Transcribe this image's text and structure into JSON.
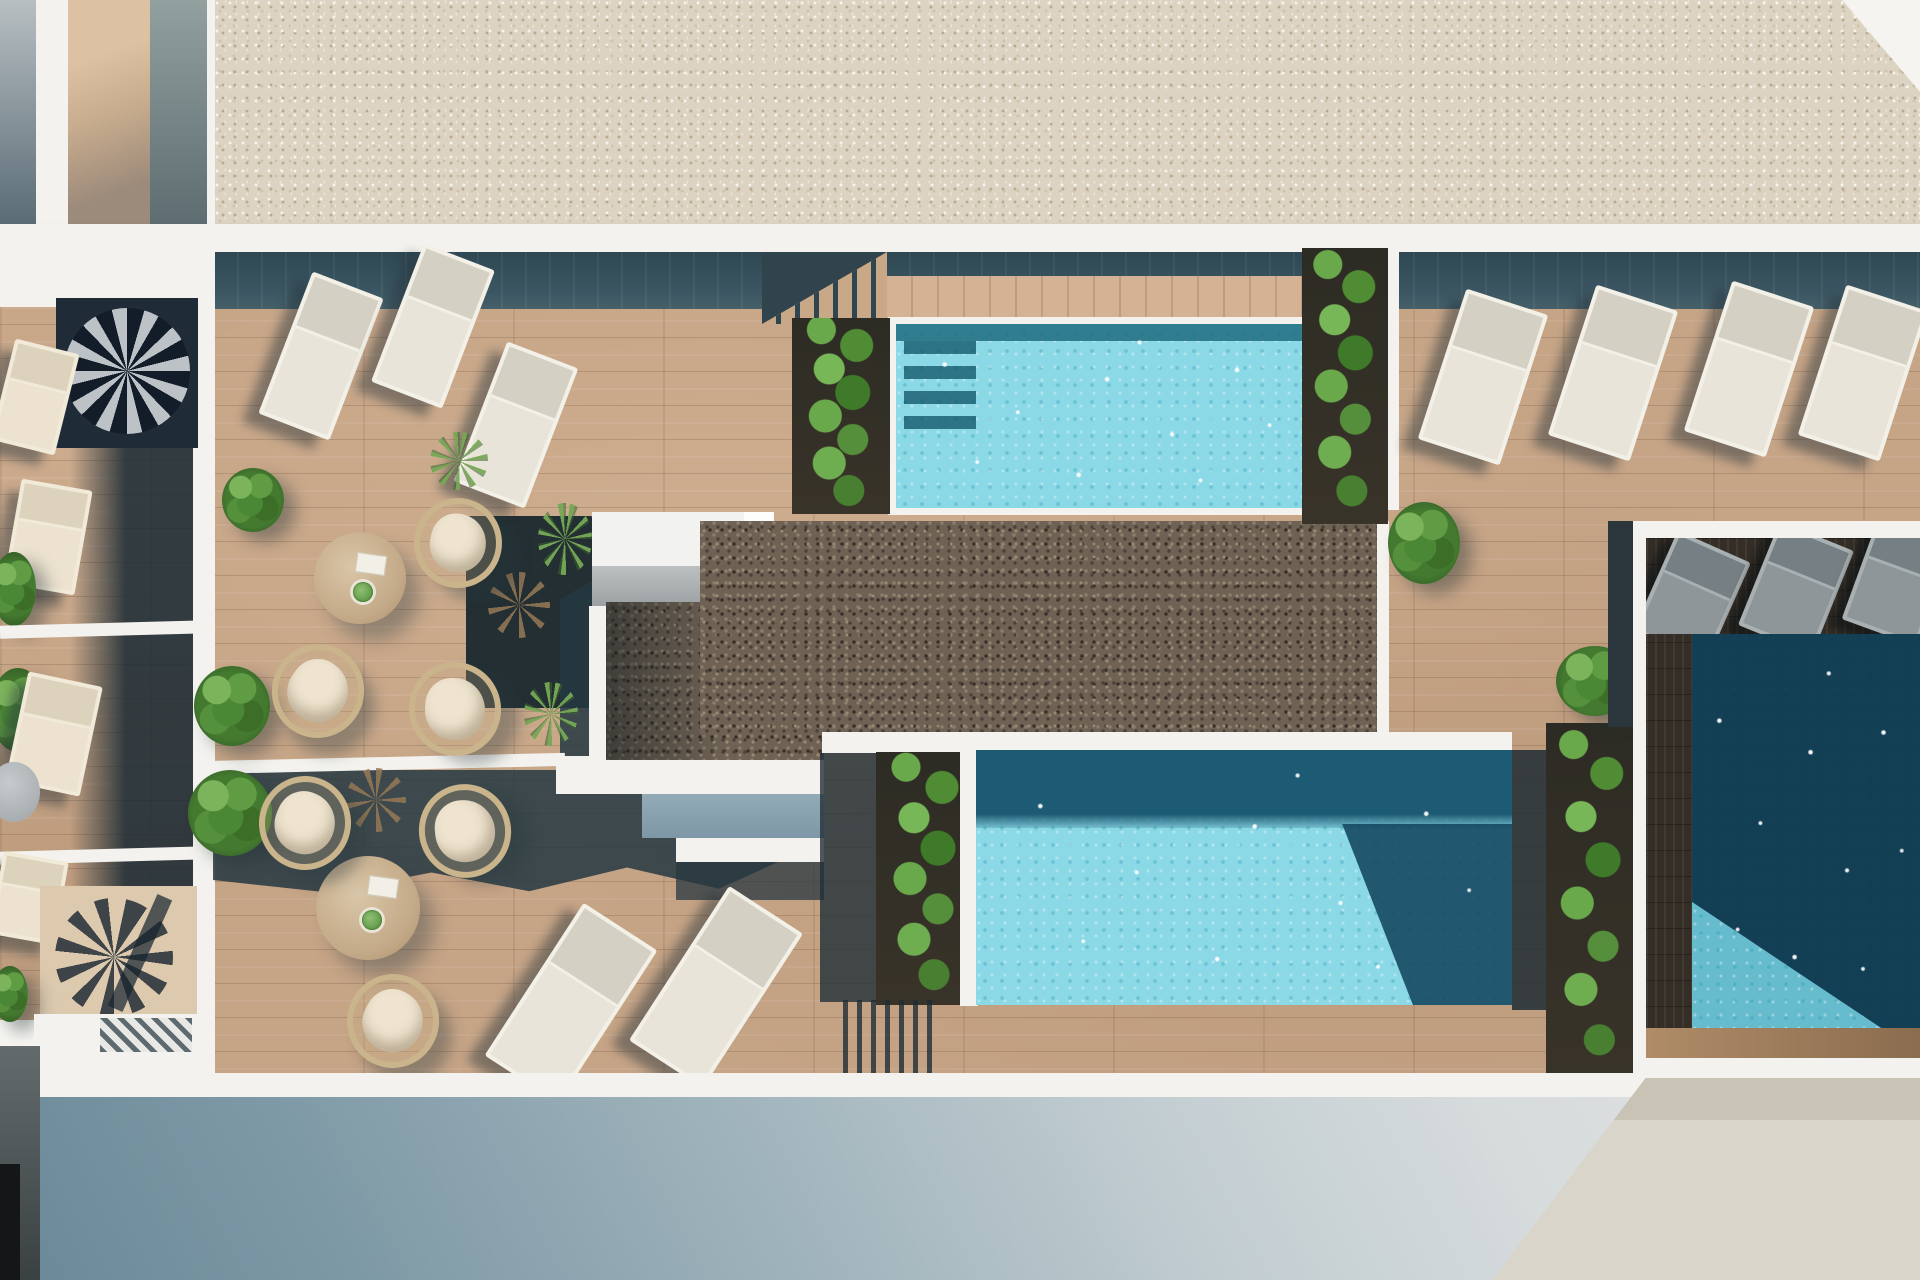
{
  "scene": {
    "title": "Rooftop pool terrace - photorealistic 3D render, top-down aerial view",
    "view": "top-down",
    "regions": [
      "roof-gravel-strip",
      "main-wood-deck",
      "top-pool",
      "center-pool",
      "right-private-pool",
      "central-dark-gravel",
      "skylight-structure",
      "left-balcony-column",
      "street-facade"
    ],
    "inventory": {
      "pools": 3,
      "sun_loungers_white": 9,
      "balcony_loungers_beige": 4,
      "shaded_loungers_gray": 3,
      "round_rattan_chairs": 6,
      "round_tables": 2,
      "side_tables": 1,
      "spiral_staircases": 2,
      "shrubs": 9,
      "yucca_plants": 3,
      "dried_plants": 2,
      "climbing_plant_planters": 4,
      "deck_step_flights": 2
    }
  },
  "palette": {
    "white_paint": "#f3f2ee",
    "gravel_light": "#ddd3c3",
    "gravel_dark": "#6f6254",
    "deck_wood": "#c6a486",
    "dark_deck": "#352e26",
    "shadow_teal": "#3b5662",
    "water_turquoise": "#8bd9e6",
    "water_deep": "#1d5a74",
    "water_navy": "#12405b",
    "slate_wall": "#87a0ae",
    "warm_wall": "#dad5ca",
    "facade_dark": "#698897",
    "facade_light": "#dde0e0",
    "plant_green": "#55913d",
    "cushion_beige": "#ece2cf"
  }
}
